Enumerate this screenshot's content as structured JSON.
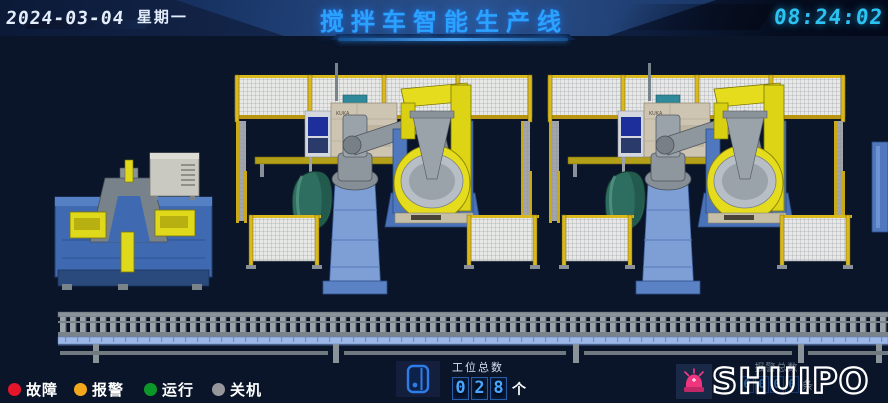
{
  "header": {
    "date": "2024-03-04",
    "weekday": "星期一",
    "title": "搅拌车智能生产线",
    "time": "08:24:02"
  },
  "scene": {
    "kuka_label": "KUKA",
    "colors": {
      "background": "#0a1529",
      "fence_yellow": "#d9b91e",
      "fence_mesh": "#e8e8e6",
      "robot_gray": "#8e969e",
      "positioner_yellow": "#e4dc1c",
      "machine_blue": "#4a72b8",
      "drum_teal": "#2e6e60",
      "conveyor_beam_blue": "#9db8e8"
    }
  },
  "footer": {
    "legend": {
      "items": [
        {
          "label": "故障",
          "color": "#e6152a"
        },
        {
          "label": "报警",
          "color": "#f2a81d"
        },
        {
          "label": "运行",
          "color": "#0c9828"
        },
        {
          "label": "关机",
          "color": "#97979b"
        }
      ]
    },
    "station_counter": {
      "label": "工位总数",
      "digits": [
        "0",
        "2",
        "8"
      ],
      "unit": "个",
      "icon": "hmi-panel-icon",
      "digit_color": "#49a6ff"
    },
    "alarm_counter": {
      "label": "报警总数",
      "digits": [
        "0",
        "0",
        "0",
        "0"
      ],
      "unit": "条"
    },
    "logo": {
      "text": "SHUIPO",
      "icon": "alarm-beacon-icon"
    }
  }
}
